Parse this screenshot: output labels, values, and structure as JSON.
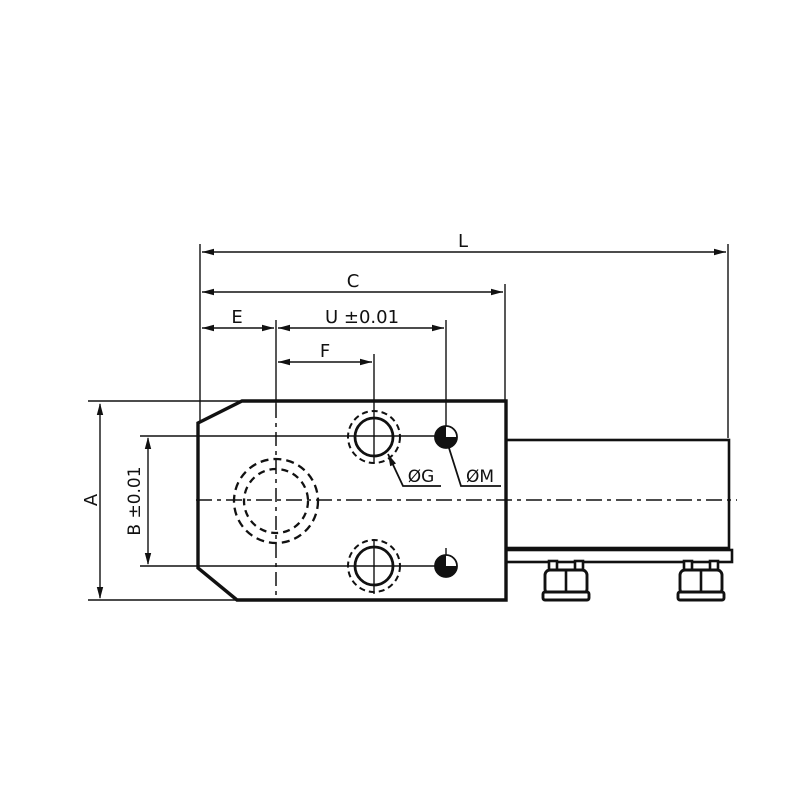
{
  "colors": {
    "background": "#ffffff",
    "line": "#111111"
  },
  "dimensions": {
    "L": "L",
    "C": "C",
    "E": "E",
    "U": "U ±0.01",
    "F": "F",
    "A": "A",
    "B": "B ±0.01"
  },
  "hole_labels": {
    "G": "ØG",
    "M": "ØM"
  }
}
